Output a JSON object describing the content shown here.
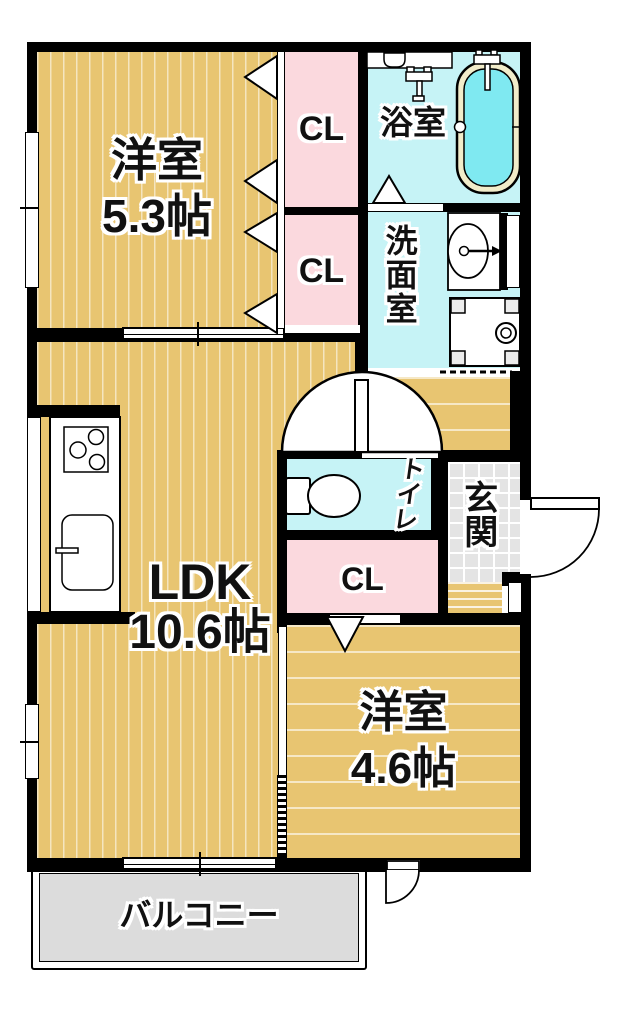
{
  "plan_title": "1LDK apartment floor plan",
  "rooms": {
    "bedroom_upper": {
      "name": "洋室",
      "size": "5.3帖"
    },
    "ldk": {
      "name": "LDK",
      "size": "10.6帖"
    },
    "bedroom_lower": {
      "name": "洋室",
      "size": "4.6帖"
    },
    "bathroom": {
      "name": "浴室"
    },
    "washroom": {
      "name": "洗面室"
    },
    "toilet": {
      "name": "トイレ"
    },
    "entrance": {
      "name": "玄関"
    },
    "balcony": {
      "name": "バルコニー"
    },
    "closet_upper": {
      "label": "CL"
    },
    "closet_lower": {
      "label": "CL"
    },
    "closet_hall": {
      "label": "CL"
    }
  },
  "colors": {
    "wall": "#000000",
    "wood": "#e8c571",
    "pink": "#fbd9de",
    "cyan": "#c6f3f6",
    "tubwater": "#7fe9f1",
    "tubrim": "#f1ecca",
    "tile": "#e4e4e4",
    "balcony": "#dcdcdc"
  }
}
